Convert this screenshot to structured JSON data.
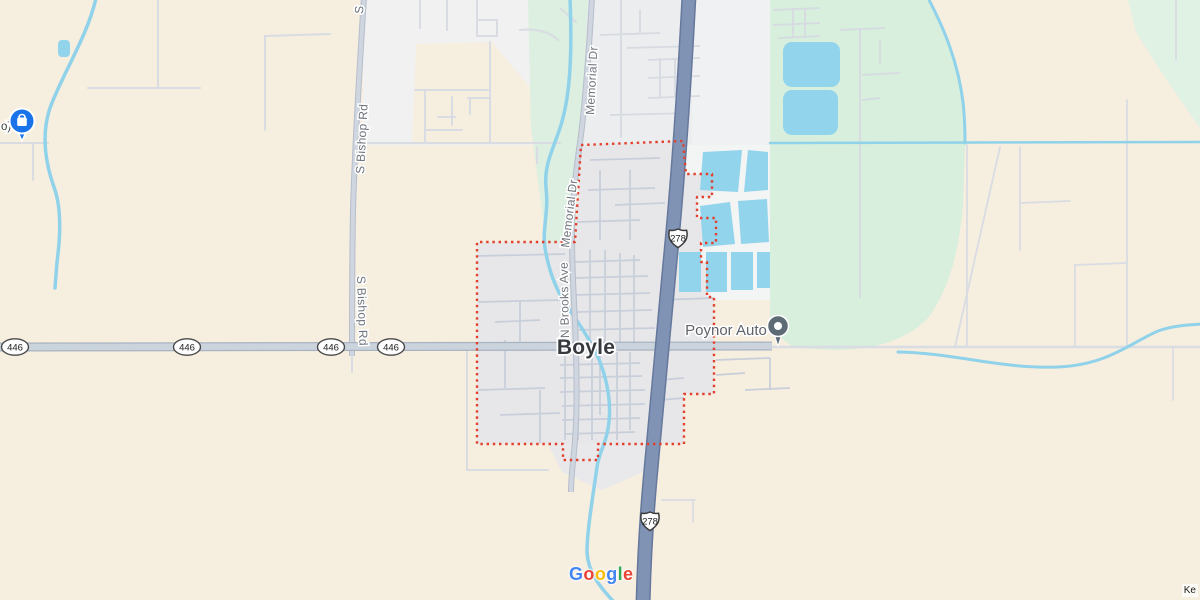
{
  "map": {
    "app": "google-maps",
    "place": {
      "town_label": "Boyle"
    },
    "road_labels": {
      "memorial_dr": "Memorial Dr",
      "n_brooks_ave": "N Brooks Ave",
      "s_bishop_rd": "S Bishop Rd",
      "s_bishop_partial": "S"
    },
    "route_shields": {
      "us_278": "278",
      "ms_446": "446"
    },
    "pois": {
      "poynor_auto": "Poynor Auto",
      "left_partial": "o)"
    },
    "attribution": {
      "google": "Google",
      "google_letters": [
        "G",
        "o",
        "o",
        "g",
        "l",
        "e"
      ],
      "keyboard_shortcuts_partial": "Ke"
    },
    "colors": {
      "land_beige": "#F6EEDF",
      "urban_white": "#F1F1F2",
      "urban_gray": "#ECEDEF",
      "town_fill": "#E7E7E9",
      "park_green": "#D7EFDC",
      "green_strip": "#DCEFE0",
      "water_blue": "#92D4EC",
      "stream_blue": "#8FD2EA",
      "highway_fill": "#8093B5",
      "highway_casing": "#66789C",
      "road_fill": "#CBD3DD",
      "boundary_red": "#E2402C",
      "pin_blue": "#1A73E8",
      "pin_gray": "#5D6B77"
    }
  }
}
